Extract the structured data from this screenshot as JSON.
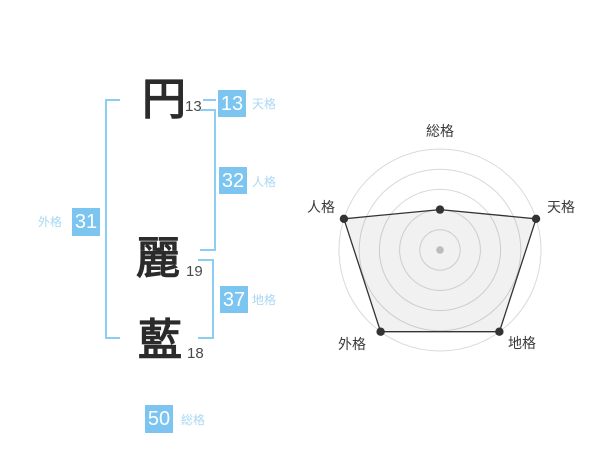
{
  "name": {
    "characters": [
      {
        "char": "円",
        "strokes": "13"
      },
      {
        "char": "麗",
        "strokes": "19"
      },
      {
        "char": "藍",
        "strokes": "18"
      }
    ]
  },
  "grids": {
    "tenkaku": {
      "value": "13",
      "label": "天格"
    },
    "jinkaku": {
      "value": "32",
      "label": "人格"
    },
    "chikaku": {
      "value": "37",
      "label": "地格"
    },
    "gaikaku": {
      "value": "31",
      "label": "外格"
    },
    "soukaku": {
      "value": "50",
      "label": "総格"
    }
  },
  "colors": {
    "badge_blue": "#7CC5F1",
    "label_blue": "#A9D8F3",
    "bracket_blue": "#8CCDF3",
    "kanji_dark": "#2b2b2b",
    "ring_gray": "#d9d9d9",
    "polygon_dark": "#333333",
    "center_dot_gray": "#bcbcbc"
  },
  "chart_data": {
    "type": "radar",
    "axes": [
      "総格",
      "天格",
      "地格",
      "外格",
      "人格"
    ],
    "values": [
      2,
      5,
      5,
      5,
      5
    ],
    "max": 5,
    "rings": 5,
    "angles_deg": [
      90,
      18,
      -54,
      234,
      162
    ],
    "grid": "concentric-circles",
    "legend": "none",
    "center_marker": true
  }
}
